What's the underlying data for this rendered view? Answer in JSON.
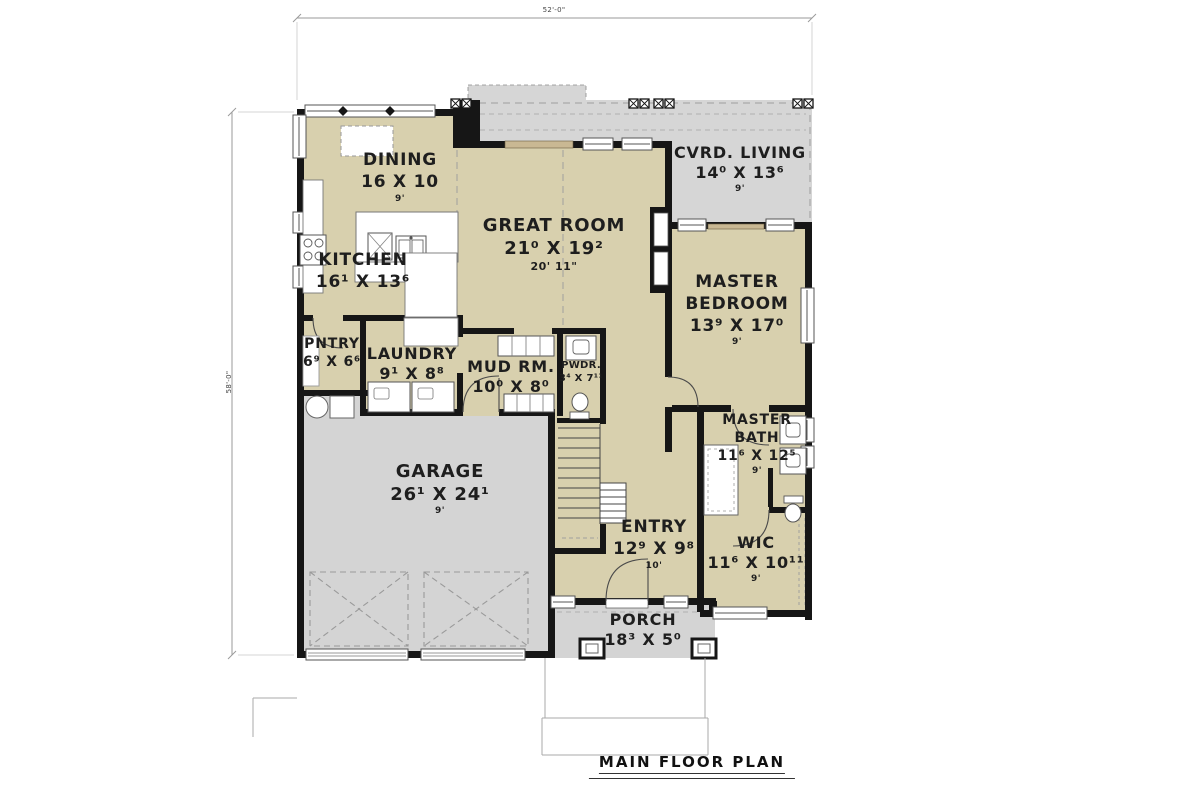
{
  "title": "MAIN FLOOR PLAN",
  "dimensions": {
    "overall_width": "52'-0\"",
    "overall_depth": "58'-0\""
  },
  "rooms": {
    "dining": {
      "name": "DINING",
      "size": "16 X 10",
      "ceiling": "9'"
    },
    "kitchen": {
      "name": "KITCHEN",
      "size": "16¹ X 13⁶"
    },
    "great_room": {
      "name": "GREAT ROOM",
      "size": "21⁰ X 19²",
      "ceiling": "20' 11\""
    },
    "cvrd_living": {
      "name": "CVRD. LIVING",
      "size": "14⁰ X 13⁶",
      "ceiling": "9'"
    },
    "master_bedroom": {
      "name_line1": "MASTER",
      "name_line2": "BEDROOM",
      "size": "13⁹ X 17⁰",
      "ceiling": "9'"
    },
    "pntry": {
      "name": "PNTRY",
      "size": "6⁹ X 6⁶"
    },
    "laundry": {
      "name": "LAUNDRY",
      "size": "9¹ X 8⁸"
    },
    "mud_rm": {
      "name": "MUD RM.",
      "size": "10⁰ X 8⁰"
    },
    "pwdr": {
      "name": "PWDR.",
      "size": "3⁴ X 7¹¹"
    },
    "master_bath": {
      "name_line1": "MASTER",
      "name_line2": "BATH",
      "size": "11⁶ X 12⁵",
      "ceiling": "9'"
    },
    "garage": {
      "name": "GARAGE",
      "size": "26¹ X 24¹",
      "ceiling": "9'"
    },
    "entry": {
      "name": "ENTRY",
      "size": "12⁹ X 9⁸",
      "ceiling": "10'"
    },
    "wic": {
      "name": "WIC",
      "size": "11⁶ X 10¹¹",
      "ceiling": "9'"
    },
    "porch": {
      "name": "PORCH",
      "size": "18³ X 5⁰"
    }
  },
  "colors": {
    "interior": "#d8d0ae",
    "outdoor": "#d4d4d4",
    "wall": "#161616",
    "door_panel": "#c9b893"
  }
}
